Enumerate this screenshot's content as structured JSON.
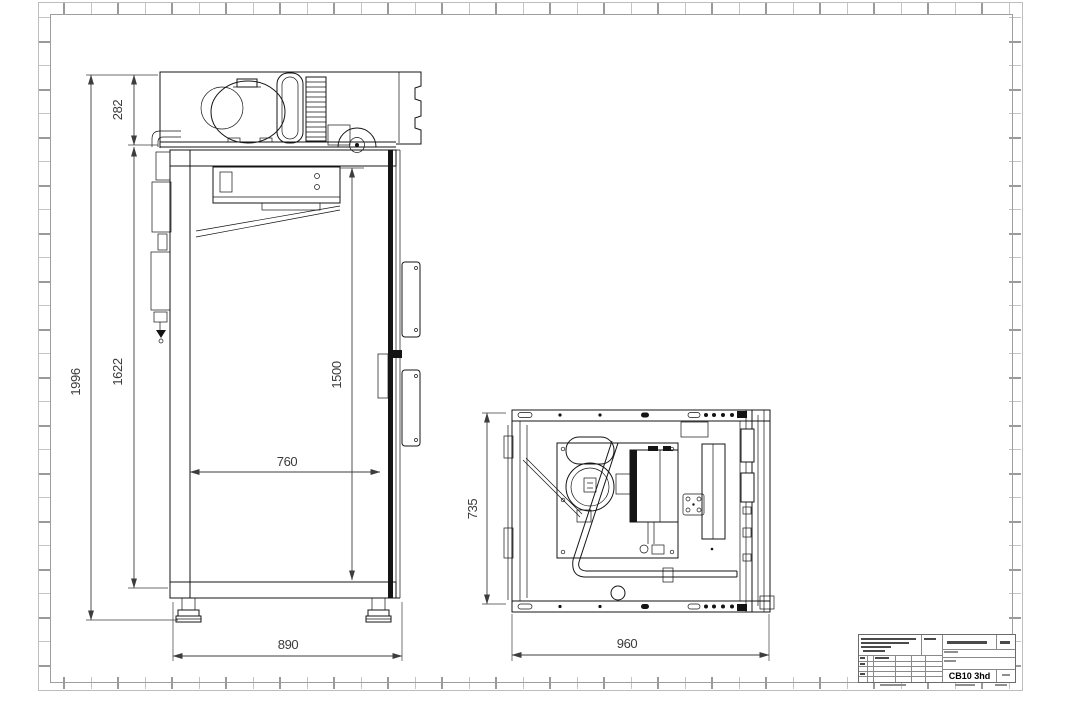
{
  "sheet": {
    "background": "#ffffff",
    "frame_color": "#bdbdbd",
    "line_color": "#141414",
    "dim_text_color": "#3a3a3a"
  },
  "drawing": {
    "side_view": {
      "label": "side-section-view",
      "dims": {
        "overall_height": "1996",
        "machine_compartment_height": "282",
        "body_height": "1622",
        "door_height": "1500",
        "inner_depth": "760",
        "overall_depth": "890"
      }
    },
    "top_view": {
      "label": "top-plan-view",
      "dims": {
        "depth": "735",
        "overall_width": "960"
      }
    }
  },
  "title_block": {
    "model": "CB10 3hd"
  }
}
